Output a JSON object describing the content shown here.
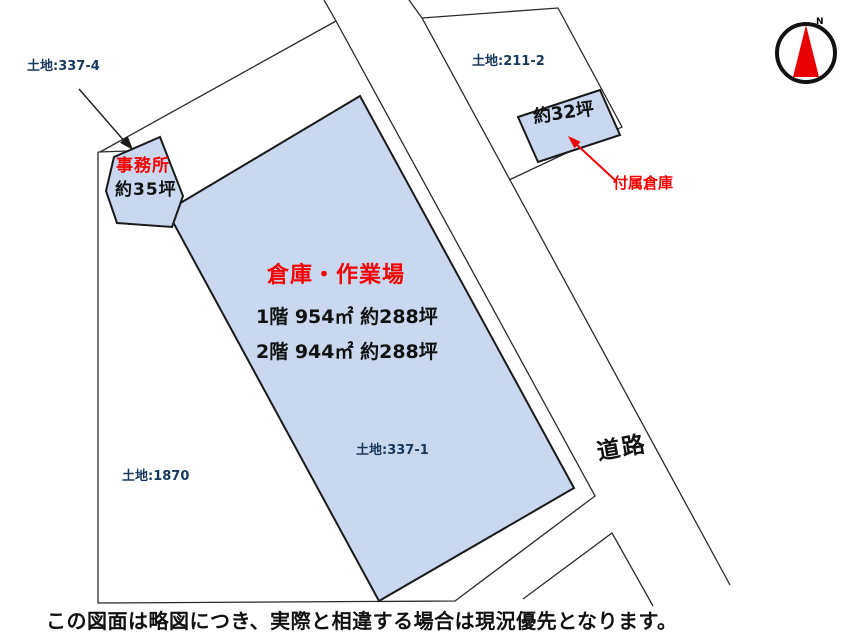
{
  "diagram": {
    "parcels": {
      "parcel_337_4_label": "土地:337-4",
      "parcel_337_1_label": "土地:337-1",
      "parcel_1870_label": "土地:1870",
      "parcel_211_2_label": "土地:211-2"
    },
    "buildings": {
      "office": {
        "name": "事務所",
        "area": "約35坪"
      },
      "warehouse": {
        "title": "倉庫・作業場",
        "floor1": "1階 954㎡ 約288坪",
        "floor2": "2階 944㎡ 約288坪"
      },
      "annex": {
        "area": "約32坪",
        "label": "付属倉庫"
      }
    },
    "road_label": "道路",
    "compass": {
      "north_label": "N"
    },
    "footnote": "この図面は略図につき、実際と相違する場合は現況優先となります。",
    "colors": {
      "building_fill": "#c9d8ef",
      "outline": "#1a1a1a",
      "parcel_line": "#2b2b2b",
      "label_blue": "#17375d",
      "accent_red": "#f40000"
    }
  }
}
